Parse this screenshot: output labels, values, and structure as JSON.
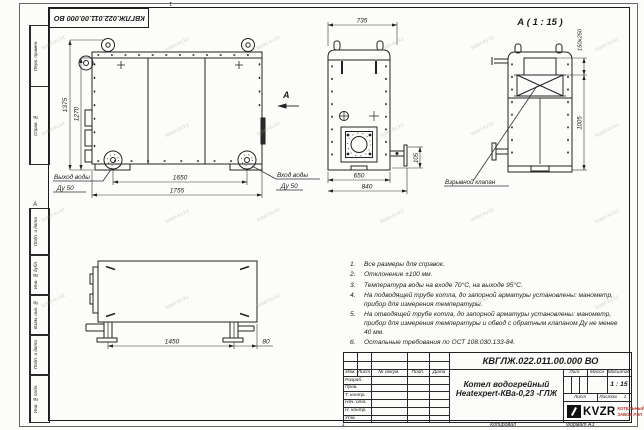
{
  "watermark": {
    "text": "kotel-kv.kz"
  },
  "doc": {
    "number": "КВГЛЖ.022.011.00.000 ВО"
  },
  "frame": {
    "zone_top": "1",
    "zone_bottom": "1",
    "copied": "Копировал",
    "format": "Формат А3",
    "margin_view_letter": "А"
  },
  "stamps": {
    "perv_primen": "Перв. примен.",
    "sprav_no": "Справ. №",
    "podp_data_1": "Подп. и дата",
    "inv_dubl": "Инв. № дубл.",
    "vzam_inv": "Взам. инв. №",
    "podp_data_2": "Подп. и дата",
    "inv_podl": "Инв. № подл."
  },
  "views": {
    "front": {
      "dim_height_outer": "1375",
      "dim_height_inner": "1270",
      "dim_width_inner": "1650",
      "dim_width_outer": "1755",
      "outlet_line1": "Выход воды",
      "outlet_line2": "Ду 50",
      "inlet_line1": "Вход воды",
      "inlet_line2": "Ду 50",
      "view_arrow": "А"
    },
    "top": {
      "dim_width": "735",
      "dim_inner": "650",
      "dim_outer": "840",
      "dim_flange": "105"
    },
    "detail": {
      "title": "А ( 1 : 15 )",
      "dim_valve": "150x250",
      "dim_height": "1005",
      "callout": "Взрывной клапан"
    },
    "side": {
      "dim_length": "1450",
      "dim_offset": "80"
    }
  },
  "notes": {
    "n1": {
      "num": "1.",
      "text": "Все размеры для справок."
    },
    "n2": {
      "num": "2.",
      "text": "Отклонение ±100 мм."
    },
    "n3": {
      "num": "3.",
      "text": "Температура воды на входе 70°С, на выходе 95°С."
    },
    "n4": {
      "num": "4.",
      "text": "На подводящей трубе котла, до запорной арматуры установлены: манометр, прибор для измерения температуры."
    },
    "n5": {
      "num": "5.",
      "text": "На отводящей трубе котла, до запорной арматуры установлены: манометр, прибор для измерения температуры и обвод с обратным клапаном Ду не менее 40 мм."
    },
    "n6": {
      "num": "6.",
      "text": "Остальные требования по ОСТ 108.030.133-84."
    }
  },
  "title_block": {
    "name_line1": "Котел водогрейный",
    "name_line2": "Heatexpert-КВа-0,23 -ГЛЖ",
    "col_izm": "Изм.",
    "col_list": "Лист",
    "col_docum": "№ докум.",
    "col_podp": "Подп.",
    "col_data": "Дата",
    "row_razrab": "Разраб.",
    "row_prov": "Пров.",
    "row_tkontr": "Т. контр.",
    "row_nachotd": "Нач. отд.",
    "row_nkontr": "Н. контр.",
    "row_utv": "Утв.",
    "lit_label": "Лит.",
    "massa_label": "Масса",
    "masshtab_label": "Масштаб",
    "scale": "1 : 15",
    "list_label": "Лист",
    "listov_label": "Листов",
    "listov_value": "1",
    "logo_text": "KVZR",
    "logo_line1": "КОТЕЛЬНЫЙ",
    "logo_line2": "ЗАВОД РЭП",
    "logo_color": "#b5342c"
  }
}
